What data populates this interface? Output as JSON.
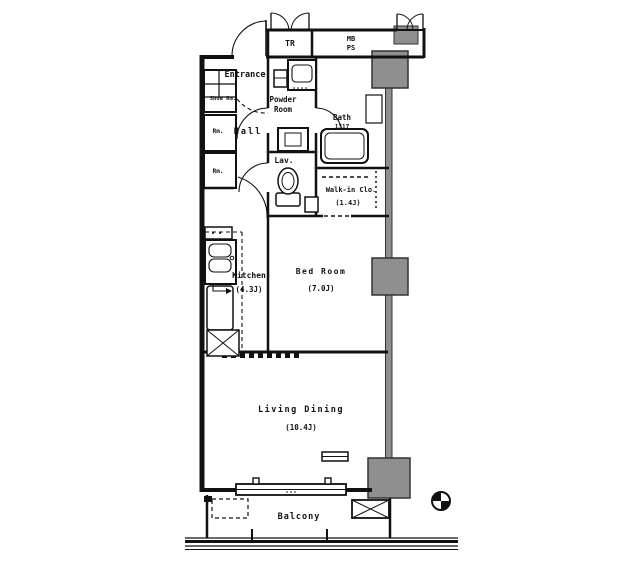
{
  "colors": {
    "wall": "#111111",
    "column_fill": "#8f8f8f",
    "background": "#ffffff"
  },
  "rooms": {
    "trunk": {
      "label": "TR"
    },
    "meter_box": {
      "line1": "MB",
      "line2": "PS"
    },
    "entrance": {
      "label": "Entrance"
    },
    "shoe": {
      "label": "Shoe Rm."
    },
    "powder": {
      "line1": "Powder",
      "line2": "Room"
    },
    "bath": {
      "label": "Bath",
      "size": "1317"
    },
    "hall": {
      "label": "Hall"
    },
    "storage1": {
      "label": "Rm."
    },
    "storage2": {
      "label": "Rm."
    },
    "lav": {
      "label": "Lav."
    },
    "walkin": {
      "label": "Walk-in Clo.",
      "size": "(1.4J)"
    },
    "kitchen": {
      "label": "Kitchen",
      "size": "(4.3J)"
    },
    "bedroom": {
      "label": "Bed Room",
      "size": "(7.0J)"
    },
    "living": {
      "label": "Living Dining",
      "size": "(10.4J)"
    },
    "balcony": {
      "label": "Balcony"
    }
  },
  "fixtures": {
    "icons": [
      "bathtub-icon",
      "toilet-icon",
      "vanity-sink-icon",
      "kitchen-sink-icon",
      "refrigerator-box-icon",
      "washer-pan-icon",
      "ac-outdoor-unit-icon",
      "compass-icon",
      "window-icon",
      "door-swing-icon",
      "structural-column"
    ]
  }
}
